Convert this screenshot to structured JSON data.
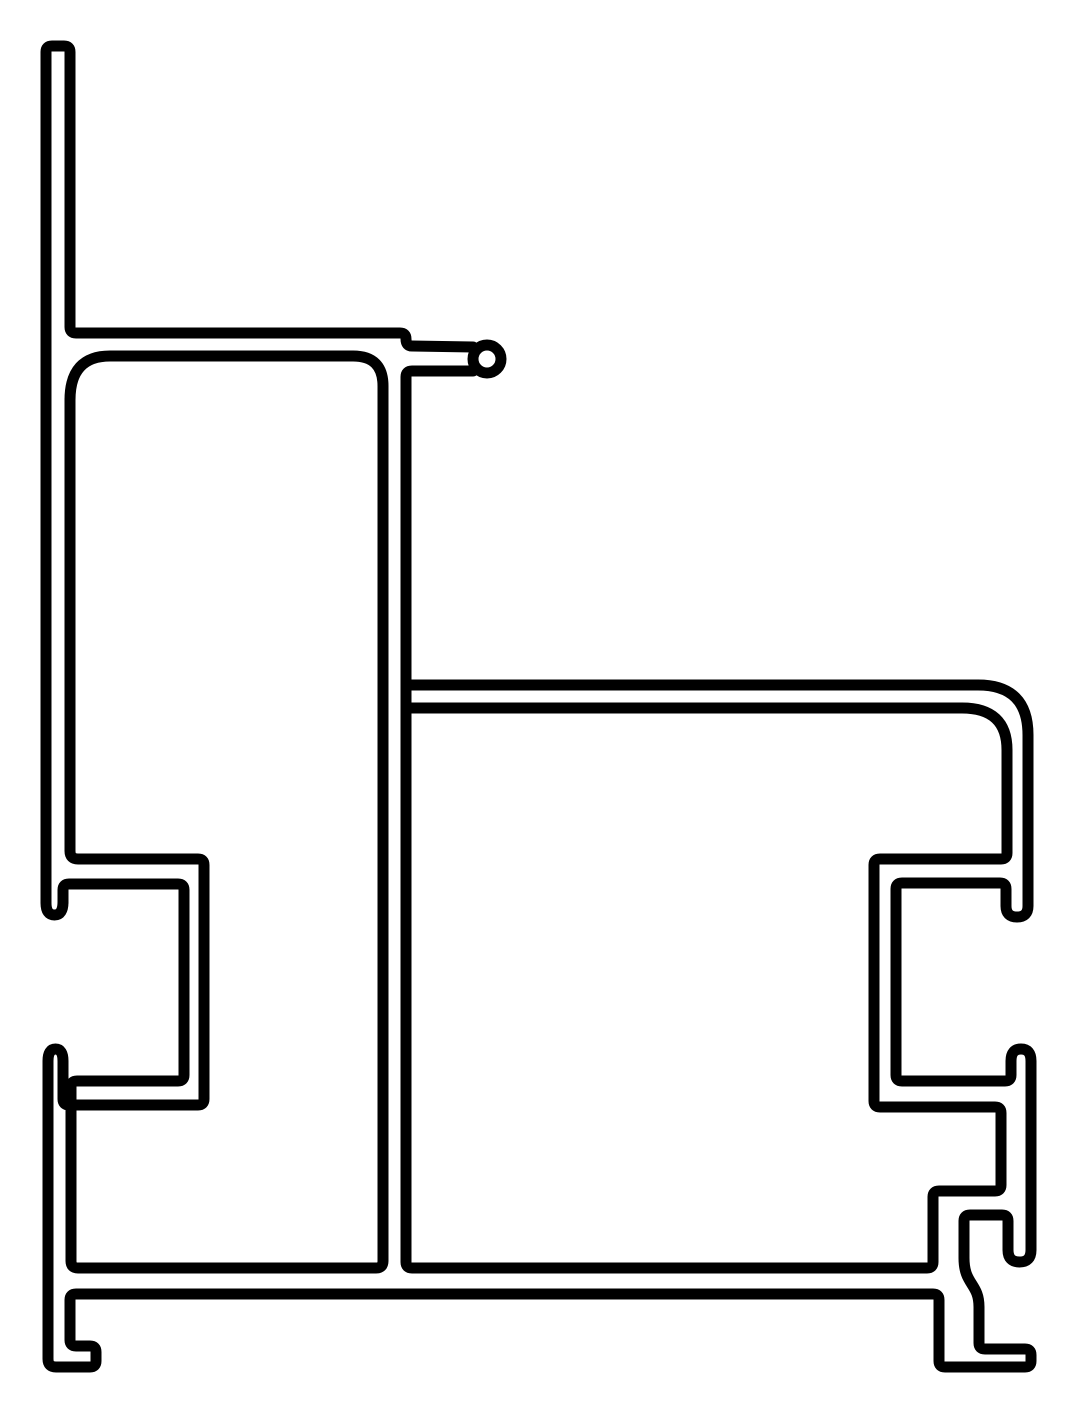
{
  "page": {
    "background_color": "#ffffff",
    "description": "Technical line drawing: extrusion profile cross-section"
  },
  "diagram": {
    "canvas": {
      "width": 1080,
      "height": 1415
    },
    "stroke": {
      "color": "#000000",
      "width": 11,
      "linecap": "round",
      "linejoin": "round",
      "fill": "none"
    },
    "paths": [
      {
        "name": "left-wall-and-glazing-shelf",
        "d": "M 63,902 Q 63,915 54.5,915 Q 46,915 46,903 L 46,52 Q 46,46 52,46 L 64,46 Q 70,46 70,52 L 70,327 Q 70,333 76,333 L 400,333 Q 406,333 406,339 Q 406,346 412,346 L 473,347"
      },
      {
        "name": "stub-underside-center-web-and-right-cavity",
        "d": "M 473,371 L 412,371 Q 406,371 406,377 L 406,1262 Q 406,1268 412,1268 L 927,1268 Q 933,1268 933,1262 L 933,1197 Q 933,1191 939,1191 L 995,1191 Q 1001,1191 1001,1185 L 1001,1113 Q 1001,1107 995,1107 L 880,1107 Q 874,1107 874,1101 L 874,865 Q 874,859 880,859 L 1001,859 Q 1007,859 1007,853 L 1007,750 Q 1007,708 962,708 L 406,708"
      },
      {
        "name": "outer-boundary-arm-hooks-feet-and-base",
        "d": "M 406,685 L 978,685 Q 1028,685 1028,735 L 1028,906 Q 1028,917 1017,917 Q 1006,917 1006,906 L 1006,889 Q 1006,883 1000,883 L 902,883 Q 896,883 896,889 L 896,1075 Q 896,1081 902,1081 L 1005,1081 Q 1011,1081 1011,1075 L 1011,1061 Q 1011,1049 1021,1049 Q 1031,1049 1031,1061 L 1031,1250 Q 1031,1262 1019.5,1262 Q 1008,1262 1008,1250 L 1008,1221 Q 1008,1215 1002,1215 L 970,1215 Q 964,1215 964,1221 L 964,1258 C 964,1285 979,1283 979,1307 L 979,1343 Q 979,1349 985,1349 L 1025,1349 Q 1031,1349 1031,1355 L 1031,1361 Q 1031,1367 1025,1367 L 945,1367 Q 939,1367 939,1361 L 939,1300 Q 939,1294 933,1294 L 76,1294 Q 70,1294 70,1300 L 70,1340 Q 70,1346 76,1346 L 90,1346 Q 96,1346 96,1352 L 96,1361 Q 96,1367 90,1367 L 56,1367 Q 48,1367 48,1359 L 48,1061 Q 48,1049 55.5,1049 Q 63,1049 63,1061 L 63,1099 Q 63,1105 69,1105 L 198,1105 Q 204,1105 204,1099 L 204,865 Q 204,859 198,859 L 78,859 Q 70,859 70,851 L 70,400"
      },
      {
        "name": "main-chamber-and-left-channel",
        "d": "M 70,400 Q 70,356 110,356 L 353,356 Q 383,356 383,386 L 383,1261 Q 383,1268 376,1268 L 78,1268 Q 71,1268 71,1261 L 71,1087 Q 71,1081 77,1081 L 178,1081 Q 184,1081 184,1075 L 184,890 Q 184,884 178,884 L 69,884 Q 63,884 63,890 L 63,902"
      }
    ],
    "circles": [
      {
        "name": "gasket-bead",
        "cx": 487,
        "cy": 359,
        "r": 14
      }
    ]
  }
}
